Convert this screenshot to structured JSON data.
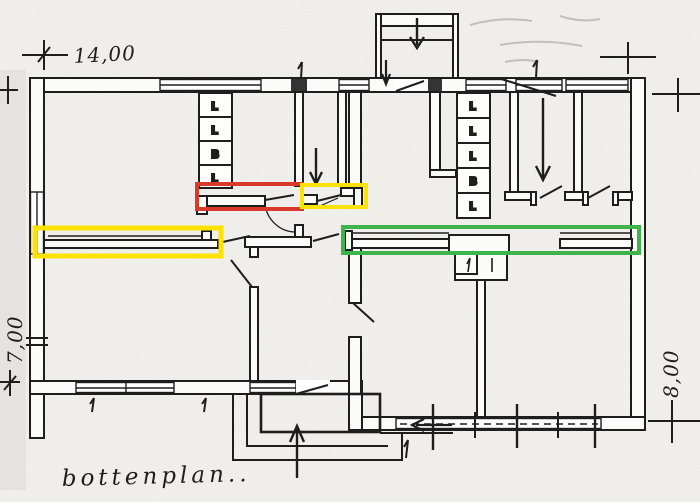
{
  "caption": "bottenplan..",
  "dimensions": {
    "top": "14,00",
    "left": "7,00",
    "right": "8,00"
  },
  "closets": {
    "left": [
      "L",
      "L",
      "B",
      "L"
    ],
    "right": [
      "L",
      "L",
      "L",
      "B",
      "L"
    ]
  },
  "colors": {
    "highlight_red": "#d93a2b",
    "highlight_yellow": "#fde303",
    "highlight_green": "#3db54a",
    "ink": "#1e1e1e",
    "paper": "#f2f1ee"
  }
}
